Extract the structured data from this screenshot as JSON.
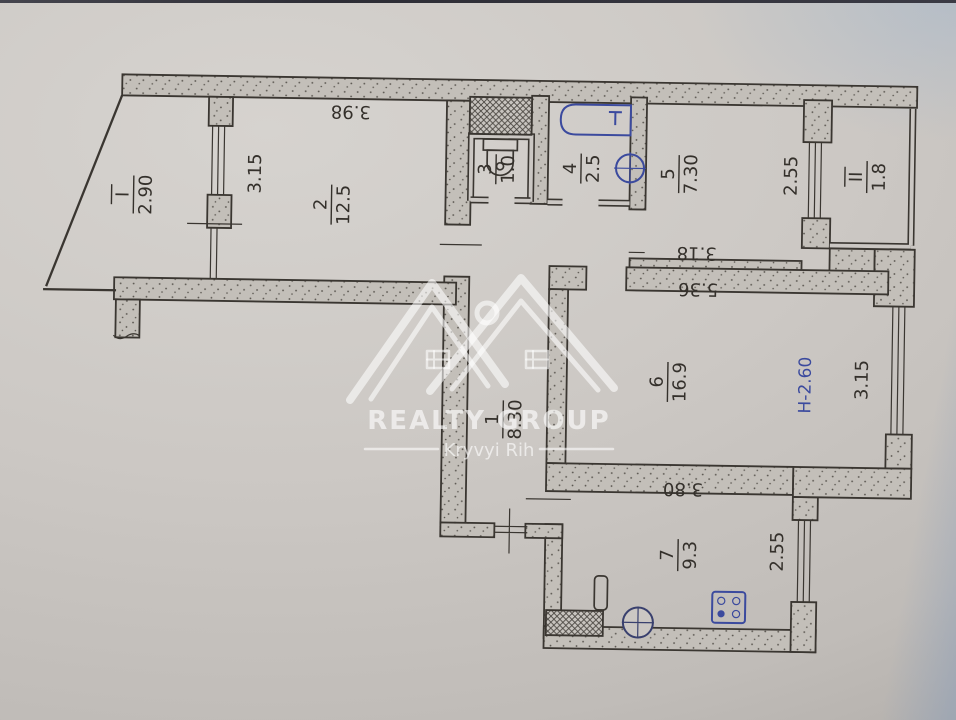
{
  "watermark": {
    "brand": "REALTY GROUP",
    "city": "Kryvyi Rih"
  },
  "palette": {
    "paper": "#cbc7c3",
    "ink": "#3a3631",
    "blue_ink": "#3b4a9e",
    "wall_fill": "#c3bfb9",
    "watermark_white": "rgba(255,255,255,0.6)"
  },
  "rooms": [
    {
      "label": "I",
      "area": "2.90",
      "name": "balcony-1",
      "overline": true
    },
    {
      "label": "2",
      "area": "12.5",
      "name": "room-2"
    },
    {
      "label": "3",
      "area": "1.0",
      "name": "wc"
    },
    {
      "label": "4",
      "area": "2.5",
      "name": "bathroom"
    },
    {
      "label": "5",
      "area": "7.30",
      "name": "room-5"
    },
    {
      "label": "II",
      "area": "1.8",
      "name": "balcony-2",
      "overline": true
    },
    {
      "label": "6",
      "area": "16.9",
      "name": "living-room"
    },
    {
      "label": "7",
      "area": "9.3",
      "name": "kitchen"
    },
    {
      "label": "1",
      "area": "8.30",
      "name": "hallway"
    }
  ],
  "dimensions": [
    {
      "value": "3.98",
      "where": "room-2 top"
    },
    {
      "value": "3.15",
      "where": "room-2 left"
    },
    {
      "value": "2.55",
      "where": "room-5 right"
    },
    {
      "value": "3.18",
      "where": "hall top"
    },
    {
      "value": "5.36",
      "where": "living-room top"
    },
    {
      "value": "3.15",
      "where": "living-room right"
    },
    {
      "value": "3.80",
      "where": "kitchen top"
    },
    {
      "value": "2.55",
      "where": "kitchen right"
    },
    {
      "value": "H-2.60",
      "where": "ceiling height",
      "blue": true
    }
  ],
  "fixtures": [
    "toilet",
    "bathtub",
    "wash-basin",
    "kitchen-sink",
    "stove",
    "vent-shaft",
    "vent-shaft"
  ]
}
